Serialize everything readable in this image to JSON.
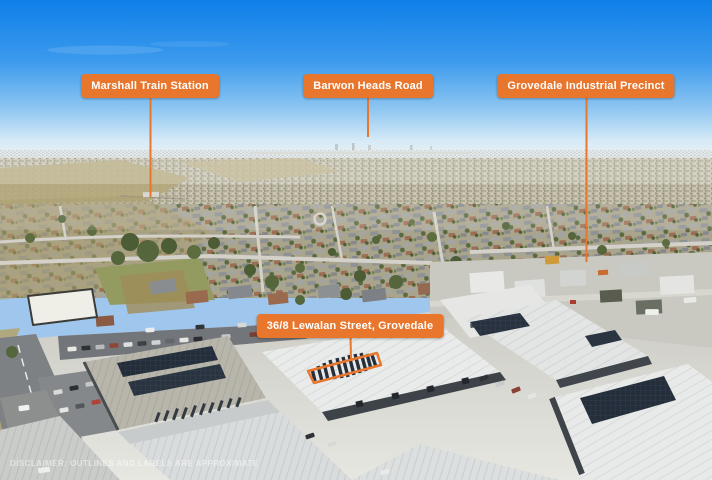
{
  "meta": {
    "description": "Aerial real-estate photograph of Grovedale with labelled landmarks and a highlighted industrial property",
    "width": 712,
    "height": 480
  },
  "colors": {
    "accent": "#E8762D",
    "label_text": "#FFFFFF",
    "sky_top": "#0F7FE8",
    "sky_horizon": "#EAF3F8",
    "solar_panel": "#262F3B"
  },
  "callouts": {
    "marshall": {
      "text": "Marshall Train Station"
    },
    "barwon": {
      "text": "Barwon Heads Road"
    },
    "grovedale": {
      "text": "Grovedale Industrial Precinct"
    },
    "property": {
      "text": "36/8 Lewalan Street, Grovedale"
    }
  },
  "watermark": {
    "disclaimer": "DISCLAIMER: Outlines and labels are approximate"
  }
}
